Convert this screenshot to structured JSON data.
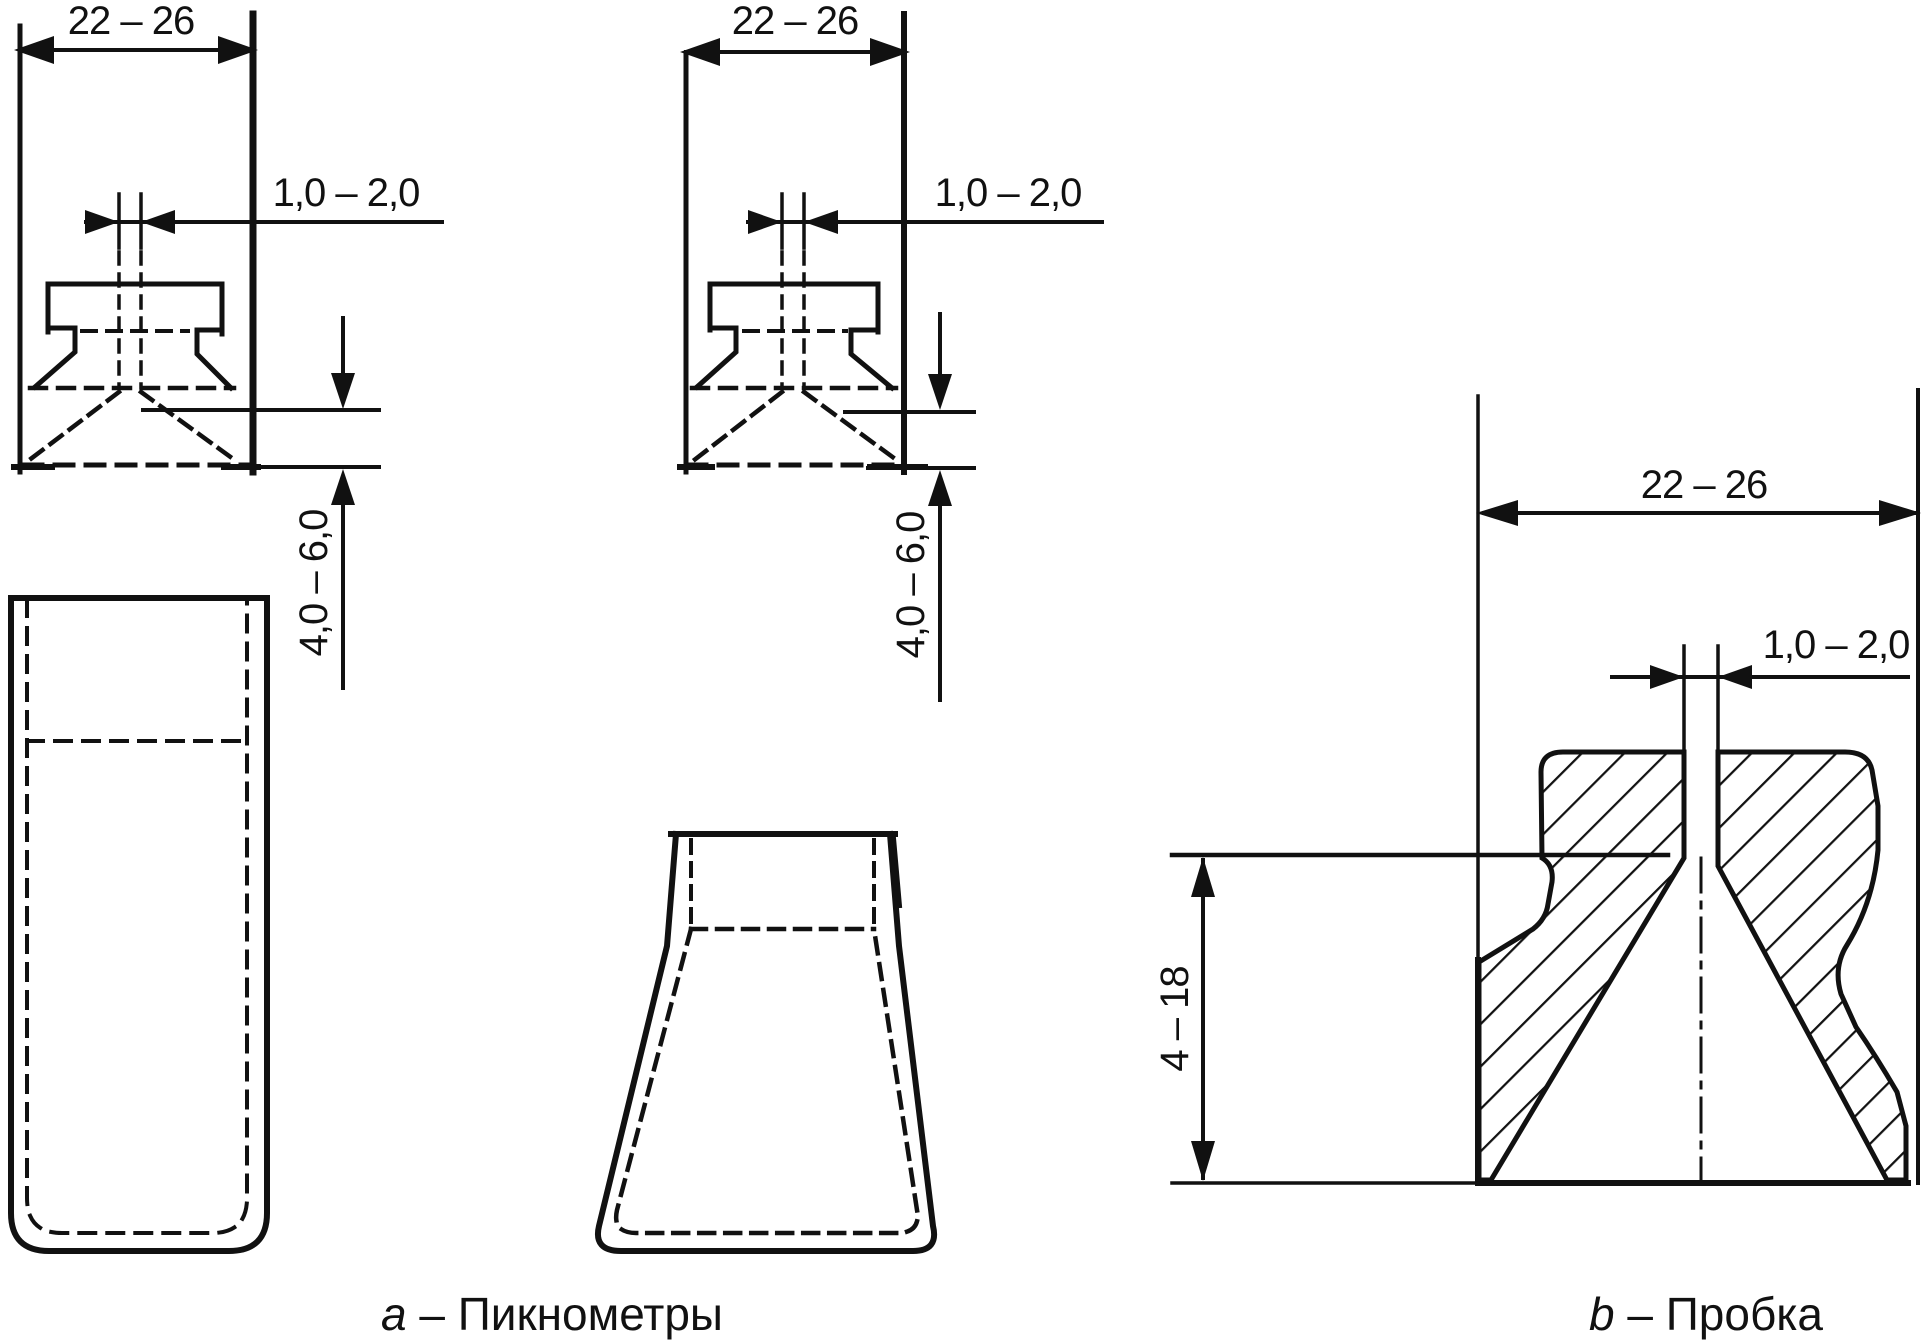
{
  "page": {
    "background_color": "#ffffff",
    "ink_color": "#111111",
    "type": "technical drawing, GOST-style pycnometer figure"
  },
  "figure_a": {
    "caption_prefix": "a",
    "caption_rest": " – Пикнометры",
    "pycnometer_1": {
      "neck_width": "22 – 26",
      "capillary_bore": "1,0 – 2,0",
      "bottom_clearance": "4,0 – 6,0"
    },
    "pycnometer_2": {
      "neck_width": "22 – 26",
      "capillary_bore": "1,0 – 2,0",
      "bottom_clearance": "4,0 – 6,0"
    }
  },
  "figure_b": {
    "caption_prefix": "b",
    "caption_rest": " – Пробка",
    "stopper": {
      "head_width": "22 – 26",
      "capillary_bore": "1,0 – 2,0",
      "plug_depth": "4 – 18"
    }
  }
}
